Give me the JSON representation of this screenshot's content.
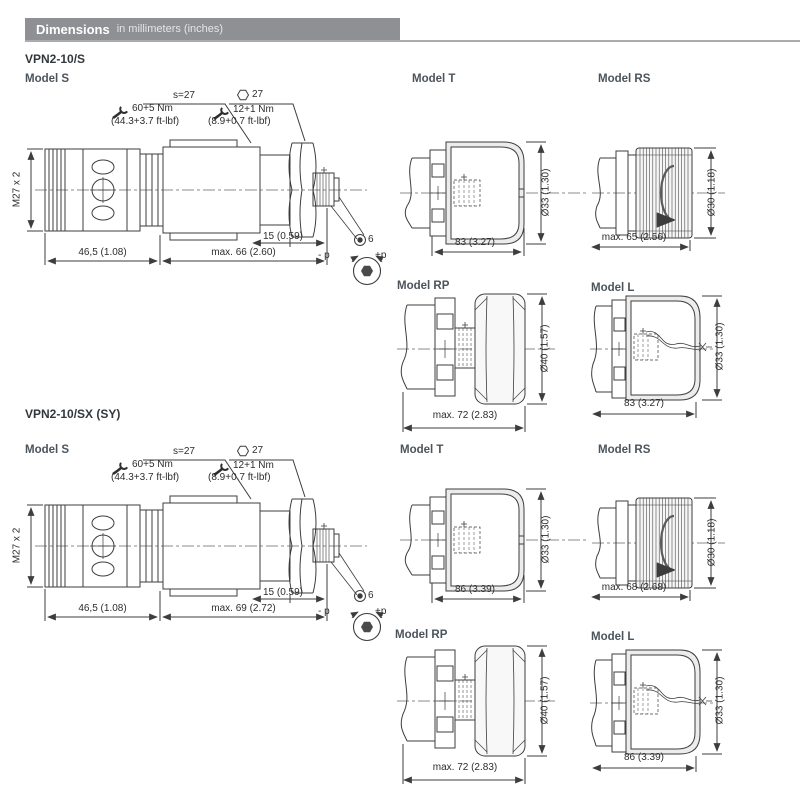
{
  "header": {
    "title": "Dimensions",
    "subtitle": "in millimeters (inches)"
  },
  "sections": [
    {
      "title": "VPN2-10/S",
      "model_s": {
        "label": "Model S",
        "wrench_size": "s=27",
        "torque1": "60+5 Nm",
        "torque1_ft": "(44.3+3.7 ft-lbf)",
        "hex_size": "27",
        "torque2": "12+1 Nm",
        "torque2_ft": "(8.9+0.7 ft-lbf)",
        "thread": "M27 x 2",
        "dim_cartridge": "46,5 (1.08)",
        "dim_total": "max. 66 (2.60)",
        "dim_screw": "15 (0.59)",
        "socket_size": "6",
        "minus_p": "- p",
        "plus_p": "+p"
      },
      "model_t": {
        "label": "Model T",
        "length": "83 (3.27)",
        "diameter": "Ø33 (1.30)"
      },
      "model_rs": {
        "label": "Model RS",
        "length": "max. 65 (2.56)",
        "diameter": "Ø30 (1.18)"
      },
      "model_rp": {
        "label": "Model RP",
        "length": "max. 72 (2.83)",
        "diameter": "Ø40 (1.57)"
      },
      "model_l": {
        "label": "Model L",
        "length": "83 (3.27)",
        "diameter": "Ø33 (1.30)"
      }
    },
    {
      "title": "VPN2-10/SX (SY)",
      "model_s": {
        "label": "Model S",
        "wrench_size": "s=27",
        "torque1": "60+5 Nm",
        "torque1_ft": "(44.3+3.7 ft-lbf)",
        "hex_size": "27",
        "torque2": "12+1 Nm",
        "torque2_ft": "(8.9+0.7 ft-lbf)",
        "thread": "M27 x 2",
        "dim_cartridge": "46,5 (1.08)",
        "dim_total": "max. 69 (2.72)",
        "dim_screw": "15 (0.59)",
        "socket_size": "6",
        "minus_p": "- p",
        "plus_p": "+p"
      },
      "model_t": {
        "label": "Model T",
        "length": "86 (3.39)",
        "diameter": "Ø33 (1.30)"
      },
      "model_rs": {
        "label": "Model RS",
        "length": "max. 68 (2.68)",
        "diameter": "Ø30 (1.18)"
      },
      "model_rp": {
        "label": "Model RP",
        "length": "max. 72 (2.83)",
        "diameter": "Ø40 (1.57)"
      },
      "model_l": {
        "label": "Model L",
        "length": "86 (3.39)",
        "diameter": "Ø33 (1.30)"
      }
    }
  ]
}
